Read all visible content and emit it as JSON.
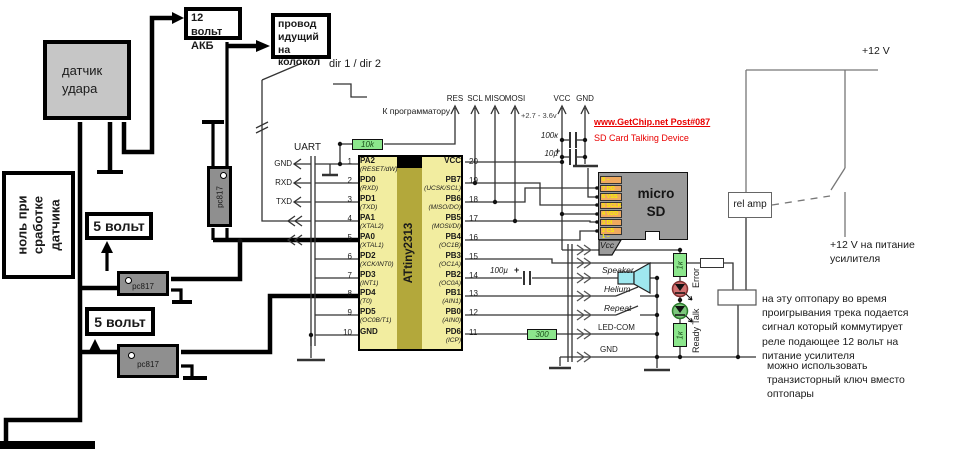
{
  "left": {
    "sensor_label": "датчик\nудара",
    "battery_label": "12 вольт\nАКБ",
    "bell_label": "провод\nидущий на\nколокол",
    "zero_label": "ноль при\nсработке\nдатчика",
    "five_volt": "5 вольт",
    "opto_label": "pc817"
  },
  "dir_label": "dir 1 / dir 2",
  "uart": {
    "label": "UART",
    "pins": [
      "GND",
      "RXD",
      "TXD"
    ]
  },
  "programmer": {
    "label": "К программатору",
    "signals": [
      "RES",
      "SCL",
      "MISO",
      "MOSI"
    ],
    "vcc": "VCC",
    "gnd": "GND",
    "voltage": "+2.7 - 3.6v"
  },
  "red_note": {
    "line1": "www.GetChip.net  Post#087",
    "line2": "SD Card Talking Device"
  },
  "mcu": {
    "name": "ATtiny2313",
    "left_pins": [
      {
        "num": "1",
        "name": "PA2",
        "alt": "(RESET/dW)"
      },
      {
        "num": "2",
        "name": "PD0",
        "alt": "(RXD)"
      },
      {
        "num": "3",
        "name": "PD1",
        "alt": "(TXD)"
      },
      {
        "num": "4",
        "name": "PA1",
        "alt": "(XTAL2)"
      },
      {
        "num": "5",
        "name": "PA0",
        "alt": "(XTAL1)"
      },
      {
        "num": "6",
        "name": "PD2",
        "alt": "(XCK/INT0)"
      },
      {
        "num": "7",
        "name": "PD3",
        "alt": "(INT1)"
      },
      {
        "num": "8",
        "name": "PD4",
        "alt": "(T0)"
      },
      {
        "num": "9",
        "name": "PD5",
        "alt": "(OC0B/T1)"
      },
      {
        "num": "10",
        "name": "GND",
        "alt": ""
      }
    ],
    "right_pins": [
      {
        "num": "20",
        "name": "VCC",
        "alt": ""
      },
      {
        "num": "19",
        "name": "PB7",
        "alt": "(UCSK/SCL)"
      },
      {
        "num": "18",
        "name": "PB6",
        "alt": "(MISO/DO)"
      },
      {
        "num": "17",
        "name": "PB5",
        "alt": "(MOSI/DI)"
      },
      {
        "num": "16",
        "name": "PB4",
        "alt": "(OC1B)"
      },
      {
        "num": "15",
        "name": "PB3",
        "alt": "(OC1A)"
      },
      {
        "num": "14",
        "name": "PB2",
        "alt": "(OC0A)"
      },
      {
        "num": "13",
        "name": "PB1",
        "alt": "(AIN1)"
      },
      {
        "num": "12",
        "name": "PB0",
        "alt": "(AIN0)"
      },
      {
        "num": "11",
        "name": "PD6",
        "alt": "(ICP)"
      }
    ]
  },
  "values": {
    "r_reset": "10k",
    "c_vcc": "100к",
    "c_el": "10µ",
    "c_speaker": "100µ",
    "polarity": "+",
    "r_ledcom": "300",
    "r_error": "1к",
    "r_ready": "1к"
  },
  "sd": {
    "line1": "micro",
    "line2": "SD",
    "pads": [
      "8 –",
      "7 DO",
      "6 VSS",
      "5 SCLK",
      "4 VDD",
      "3 DI",
      "2 CS"
    ],
    "pad_bottom": "1 –"
  },
  "signals": {
    "vcc": "Vcc",
    "speaker": "Speaker",
    "helium": "Helium",
    "repeat": "Repeat",
    "led_com": "LED-COM",
    "gnd": "GND"
  },
  "leds": {
    "error": "Error",
    "ready": "Ready Talk"
  },
  "right": {
    "rel_amp": "rel amp",
    "v12": "+12 V",
    "v12_amp": "+12 V на питание\nусилителя",
    "note1": "на эту оптопару во время\nпроигрывания трека подается\nсигнал который коммутирует\nреле подающее 12 вольт на\nпитание усилителя",
    "note2": "можно использовать\nтранзисторный ключ вместо\nоптопары"
  }
}
